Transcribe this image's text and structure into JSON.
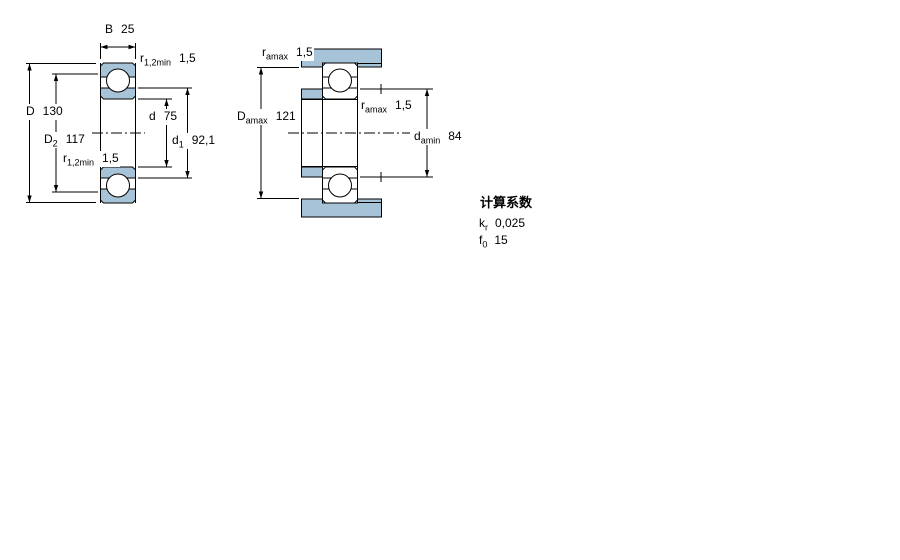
{
  "page": {
    "background": "#ffffff"
  },
  "drawing": {
    "colors": {
      "section_fill": "#a6c3d7",
      "line": "#000000"
    },
    "left_view": {
      "B": {
        "symbol": "B",
        "sub": "",
        "value": "25"
      },
      "r12_top": {
        "symbol": "r",
        "sub": "1,2min",
        "value": "1,5"
      },
      "D": {
        "symbol": "D",
        "sub": "",
        "value": "130"
      },
      "D2": {
        "symbol": "D",
        "sub": "2",
        "value": "117"
      },
      "r12_bottom": {
        "symbol": "r",
        "sub": "1,2min",
        "value": "1,5"
      },
      "d": {
        "symbol": "d",
        "sub": "",
        "value": "75"
      },
      "d1": {
        "symbol": "d",
        "sub": "1",
        "value": "92,1"
      }
    },
    "right_view": {
      "r_amax_top": {
        "symbol": "r",
        "sub": "amax",
        "value": "1,5"
      },
      "D_amax": {
        "symbol": "D",
        "sub": "amax",
        "value": "121"
      },
      "r_amax_mid": {
        "symbol": "r",
        "sub": "amax",
        "value": "1,5"
      },
      "d_amin": {
        "symbol": "d",
        "sub": "amin",
        "value": "84"
      }
    }
  },
  "calculation_factors": {
    "title": "计算系数",
    "rows": [
      {
        "symbol": "k",
        "sub": "r",
        "value": "0,025"
      },
      {
        "symbol": "f",
        "sub": "0",
        "value": "15"
      }
    ]
  }
}
